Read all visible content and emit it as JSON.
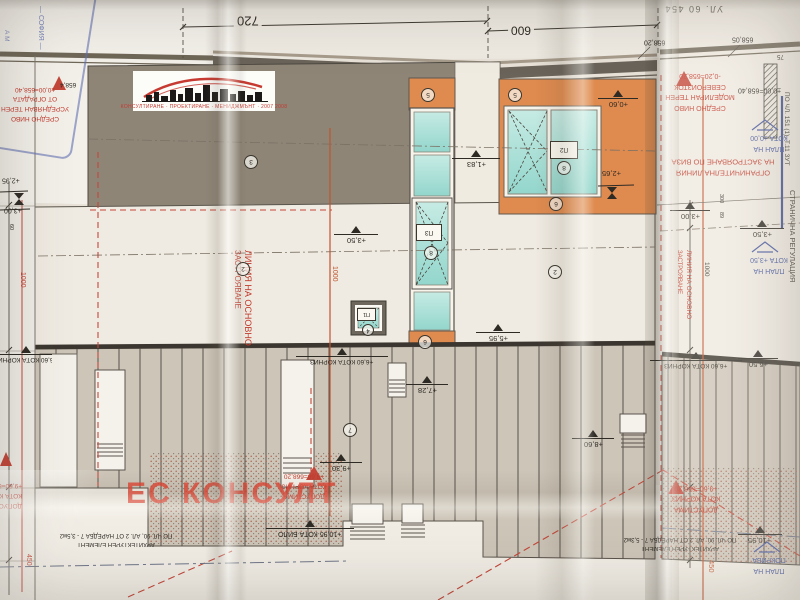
{
  "colors": {
    "red_note": "#c0392b",
    "blue_note": "#44579f",
    "orange_panel": "#df8a4e",
    "glass": "#abdfd7",
    "wall_gray": "#8e8577",
    "watermark_red": "#e04537"
  },
  "street_label": "УЛ. 60 454",
  "watermark": {
    "name": "ЕС КОНСУЛТ",
    "tagline": "КОНСУЛТИРАНЕ · ПРОЕКТИРАНЕ · МЕНИДЖМЪНТ · 2007 2008"
  },
  "stamp": {
    "city": "— СОФИЯ —",
    "fragment": "А М"
  },
  "dims": {
    "top_main": "720",
    "top_right": "600",
    "h1000_left": "1000",
    "h1000_mid": "1000",
    "h1000_right": "1000",
    "v450_left": "450",
    "v450_right": "450",
    "v300": "300",
    "v89": "89",
    "v75": "75",
    "v60": "60"
  },
  "levels": {
    "p295": "+2,95",
    "p300_left": "+3,00",
    "p350_left": "+3,50",
    "p183": "+1,83",
    "p595": "+5,95",
    "p060": "+0,60",
    "p265": "+2,65",
    "p300_right": "+3,00",
    "p350_right": "+3,50",
    "p650": "+6,50",
    "p728": "+7,28",
    "p860": "+8,60",
    "p930": "+9,30",
    "cornice_left": "+6,60 КОТА КОРНИЗ",
    "cornice_mid": "+6,60 КОТА КОРНИЗ",
    "cornice_right": "+6,60 КОТА КОРНИЗ",
    "ridge": "+10,95 КОТА БИЛО",
    "ridge_right": "+10,95",
    "e65820": "658,20",
    "e65805": "658,05",
    "e6584": "658,4",
    "zero_level": "±0,00=658,40"
  },
  "notes_red": {
    "avg_terrain": [
      "СРЕДНО НИВО",
      "УСРЕДНЯВАН ТЕРЕН",
      "ОТ ОГРАДАТА",
      "±0,00=658,40"
    ],
    "model_terrain": [
      "СРЕДНО НИВО",
      "МОДЕЛИРАН ТЕРЕН",
      "СЕВЕРОИЗТОК",
      "-0,20=658,20"
    ],
    "limit_line": [
      "ОГРАНИЧИТЕЛНА ЛИНИЯ",
      "НА ЗАСТРОЯВАНЕ ПО ВИЗА"
    ],
    "main_build_line": [
      "ЛИНИЯ НА ОСНОВНО",
      "ЗАСТРОЯВАНЕ"
    ],
    "allowed_cornice": [
      "ДОПУСТИМА",
      "КОТА КОРНИЗ",
      "+9,60=668,20"
    ]
  },
  "notes_blue": {
    "plan_zero": [
      "ПЛАН НА",
      "КОТА ±0,00"
    ],
    "plan_350": [
      "ПЛАН НА",
      "КОТА +3,50"
    ],
    "plan_roof": [
      "ПЛАН НА",
      "ПОКРИВА"
    ]
  },
  "notes_black": {
    "side_regulation": "СТРАНИЧНА РЕГУЛАЦИЯ",
    "zut": "ПО ЧЛ. 151 (1), Т.11 ЗУТ",
    "arch_element": "АРХИТЕКТУРЕН ЕЛЕМЕНТ",
    "arch_rule_left": "ПО ЧЛ. 90, АЛ. 2 ОТ НАРЕДБА 7 - 3,5м2",
    "arch_rule_right": "ПО ЧЛ. 90, АЛ. 2 ОТ НАРЕДБА 7 - 5,3м2"
  },
  "tags": {
    "wall_upper": "3",
    "wall_mid_left": "2",
    "wall_mid_right": "2",
    "roof": "7",
    "lintel_strip": "5",
    "lintel_main": "5",
    "sill_strip": "6",
    "sill_main": "6",
    "win_small": "П1",
    "win_small_no": "4",
    "win_main": "П2",
    "win_main_no": "8",
    "win_strip": "П3",
    "win_strip_no": "8"
  }
}
